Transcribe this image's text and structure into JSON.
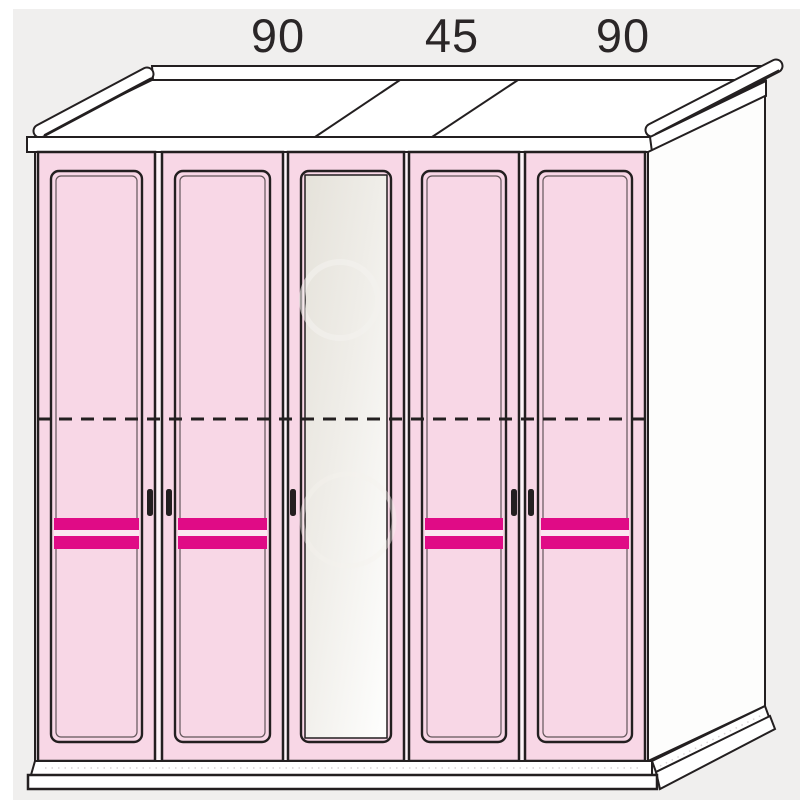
{
  "diagram": {
    "dimension_labels": [
      {
        "value": "90"
      },
      {
        "value": "45"
      },
      {
        "value": "90"
      }
    ],
    "sections_cm": [
      90,
      45,
      90
    ],
    "doors": [
      {
        "id": "door-1",
        "style": "paneled-pink",
        "handle": "right",
        "stripe_count": 2
      },
      {
        "id": "door-2",
        "style": "paneled-pink",
        "handle": "left",
        "stripe_count": 2
      },
      {
        "id": "door-3",
        "style": "mirror",
        "handle": "left",
        "stripe_count": 0
      },
      {
        "id": "door-4",
        "style": "paneled-pink",
        "handle": "right",
        "stripe_count": 2
      },
      {
        "id": "door-5",
        "style": "paneled-pink",
        "handle": "left",
        "stripe_count": 2
      }
    ],
    "features": {
      "dashed_guide_line": true,
      "center_mirror_door": true,
      "cornice_top": true,
      "plinth_base": true
    }
  },
  "colors": {
    "background": "#f0efee",
    "line": "#231f20",
    "white": "#ffffff",
    "door_pink": "#f8d7e6",
    "carcass_gap": "#fdf4f8",
    "stripe_magenta": "#e00b86",
    "stripe_gap": "#fbe7f1",
    "mirror_top": "#e5e2da",
    "mirror_mid": "#efede8",
    "mirror_bottom": "#fdfdfc",
    "side_white": "#fdfdfc",
    "label_color": "#2a2627",
    "dot_gray": "#d9d3d6"
  }
}
